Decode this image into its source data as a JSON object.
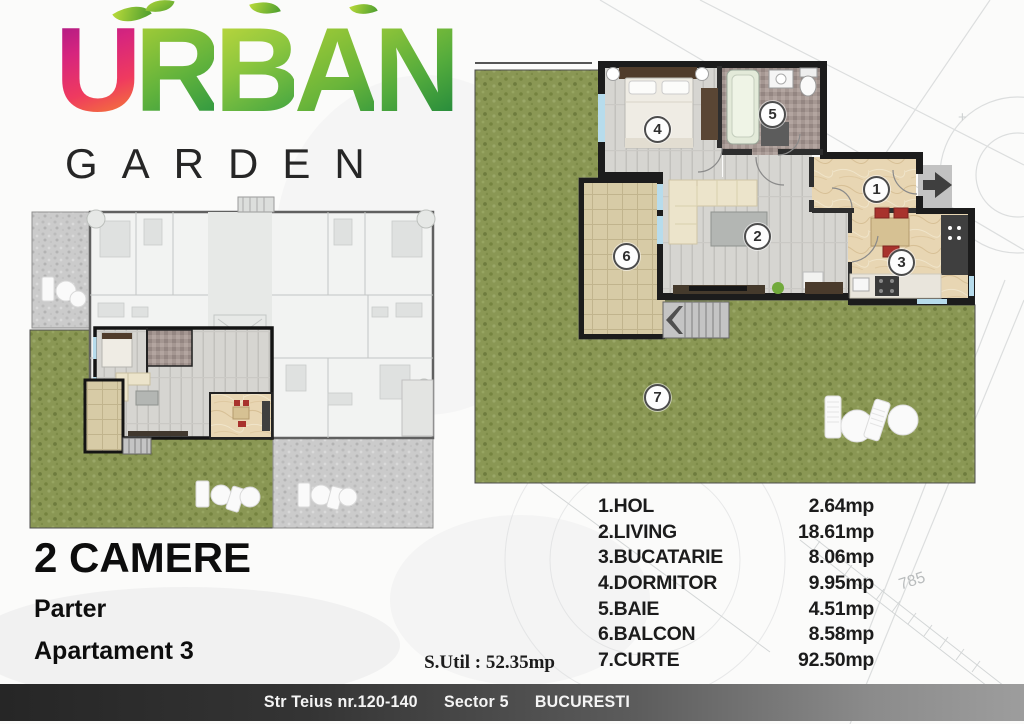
{
  "logo": {
    "brand_top": "URBAN",
    "brand_bottom": "GARDEN"
  },
  "plan_info": {
    "type_label": "2 CAMERE",
    "level_label": "Parter",
    "unit_label": "Apartament 3",
    "usable_area_label": "S.Util : 52.35mp"
  },
  "rooms": [
    {
      "num": "1",
      "name": "1.HOL",
      "area": "2.64mp"
    },
    {
      "num": "2",
      "name": "2.LIVING",
      "area": "18.61mp"
    },
    {
      "num": "3",
      "name": "3.BUCATARIE",
      "area": "8.06mp"
    },
    {
      "num": "4",
      "name": "4.DORMITOR",
      "area": "9.95mp"
    },
    {
      "num": "5",
      "name": "5.BAIE",
      "area": "4.51mp"
    },
    {
      "num": "6",
      "name": "6.BALCON",
      "area": "8.58mp"
    },
    {
      "num": "7",
      "name": "7.CURTE",
      "area": "92.50mp"
    }
  ],
  "footer": {
    "street": "Str Teius nr.120-140",
    "sector": "Sector 5",
    "city": "BUCURESTI"
  },
  "background_annotations": {
    "dimension_text": "785"
  },
  "colors": {
    "grass": "#8a9754",
    "walls": "#1c1c1c",
    "wood_floor": "#d6d5d1",
    "kitchen_floor": "#e8d6b3",
    "balcony_tile": "#d7cba6",
    "accent_red": "#a8322c",
    "logo_magenta": "#d6257e",
    "logo_green": "#62b33c",
    "bar_dark": "#262626",
    "bar_light": "#9d9d9d"
  }
}
